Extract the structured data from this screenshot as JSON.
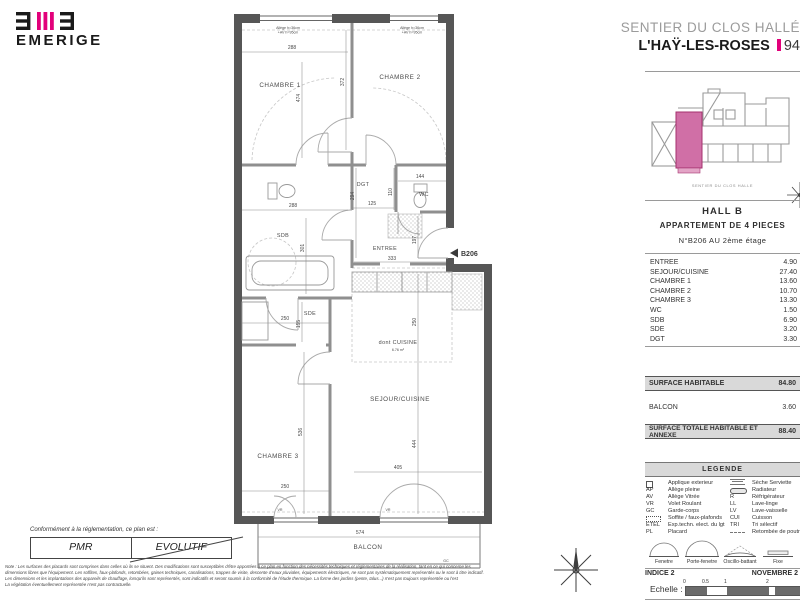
{
  "brand": {
    "name": "EMERIGE"
  },
  "header": {
    "project": "SENTIER DU CLOS HALLÉ",
    "city": "L'HAŸ-LES-ROSES",
    "dept": "94"
  },
  "site": {
    "caption": "SENTIER DU CLOS HALLE"
  },
  "unit": {
    "hall": "HALL B",
    "type": "APPARTEMENT DE 4 PIECES",
    "number": "N°B206 AU 2ème étage"
  },
  "rooms": [
    {
      "name": "ENTREE",
      "area": "4.90"
    },
    {
      "name": "SEJOUR/CUISINE",
      "area": "27.40"
    },
    {
      "name": "CHAMBRE 1",
      "area": "13.60"
    },
    {
      "name": "CHAMBRE 2",
      "area": "10.70"
    },
    {
      "name": "CHAMBRE 3",
      "area": "13.30"
    },
    {
      "name": "WC",
      "area": "1.50"
    },
    {
      "name": "SDB",
      "area": "6.90"
    },
    {
      "name": "SDE",
      "area": "3.20"
    },
    {
      "name": "DGT",
      "area": "3.30"
    }
  ],
  "surfaces": {
    "habitable_label": "SURFACE HABITABLE",
    "habitable": "84.80",
    "balcon_label": "BALCON",
    "balcon": "3.60",
    "totale_label": "SURFACE TOTALE HABITABLE ET ANNEXE",
    "totale": "88.40"
  },
  "legend": {
    "title": "LEGENDE",
    "left": [
      {
        "sym": "",
        "label": "Applique exterieur"
      },
      {
        "sym": "AP",
        "label": "Allège pleine"
      },
      {
        "sym": "AV",
        "label": "Allège Vitrée"
      },
      {
        "sym": "VR",
        "label": "Volet Roulant"
      },
      {
        "sym": "GC",
        "label": "Garde-corps"
      },
      {
        "sym": "",
        "label": "Soffite / faux-plafonds"
      },
      {
        "sym": "ETEL",
        "label": "Exp.techn. elect. du lgt"
      },
      {
        "sym": "PL",
        "label": "Placard"
      }
    ],
    "right": [
      {
        "sym": "",
        "label": "Sèche Serviette"
      },
      {
        "sym": "",
        "label": "Radiateur"
      },
      {
        "sym": "R",
        "label": "Réfrigérateur"
      },
      {
        "sym": "LL",
        "label": "Lave-linge"
      },
      {
        "sym": "LV",
        "label": "Lave-vaisselle"
      },
      {
        "sym": "CUI",
        "label": "Cuisson"
      },
      {
        "sym": "TRI",
        "label": "Tri sélectif"
      },
      {
        "sym": "",
        "label": "Retombée de poutre"
      }
    ],
    "windows": [
      "Fenetre",
      "Porte-fenetre",
      "Oscillo-battant",
      "Fixe"
    ]
  },
  "footer_panel": {
    "indice": "INDICE 2",
    "date": "NOVEMBRE 2",
    "echelle": "Echelle :",
    "ticks": [
      "0",
      "0.5",
      "1",
      "2"
    ]
  },
  "plan": {
    "marker": "B206",
    "labels": {
      "chambre1": "CHAMBRE 1",
      "chambre2": "CHAMBRE 2",
      "chambre3": "CHAMBRE 3",
      "dgt": "DGT",
      "wc": "WC",
      "sdb": "SDB",
      "sde": "SDE",
      "entree": "ENTREE",
      "cuisine": "dont CUISINE",
      "cuisine_area": "6.76 m²",
      "sejour": "SEJOUR/CUISINE",
      "balcon": "BALCON",
      "gc": "GC",
      "vr": "VR",
      "win_note1": "Allège h=36cm",
      "win_note2": "+AV h=95cm"
    },
    "dims": {
      "d288a": "288",
      "d474": "474",
      "d372": "372",
      "d288b": "288",
      "d301": "301",
      "d294": "294",
      "d125": "125",
      "d144": "144",
      "d110": "110",
      "d333": "333",
      "d197": "197",
      "d250sde": "250",
      "d155": "155",
      "d250k": "250",
      "d536": "536",
      "d250c3": "250",
      "d444": "444",
      "d405": "405",
      "d574": "574"
    }
  },
  "conformity": {
    "intro": "Conformément à la réglementation, ce plan est :",
    "pmr": "PMR",
    "evolutif": "EVOLUTIF"
  },
  "notes": {
    "l1": "Note : Les surfaces des placards sont comprises dans celles où ils se situent. Des modifications sont susceptibles d'être apportées à ce plan en fonction des nécessités techniques et réglementaires de la réalisation, tant en ce qui concerne les",
    "l2": "dimensions libres que l'équipement. Les soffites, faux-plafonds, retombées, gaines techniques, canalisations, trappes de visite, descente d'eaux pluviales, équipements électriques, ne sont pas systématiquement représentés ou le sont à titre indicatif.",
    "l3": "Les dimensions et les implantations des appareils de chauffage, lorsqu'ils sont représentés, sont indicatifs et seront soumis à la conformité de l'étude thermique. La forme des jardins (pente, talus...) n'est pas toujours représentée ou l'est",
    "l4": "La végétation éventuellement représentée n'est pas contractuelle."
  },
  "colors": {
    "accent": "#e2007a",
    "site_highlight": "#d06fa6",
    "wall": "#565656",
    "band": "#d9d9d9"
  }
}
